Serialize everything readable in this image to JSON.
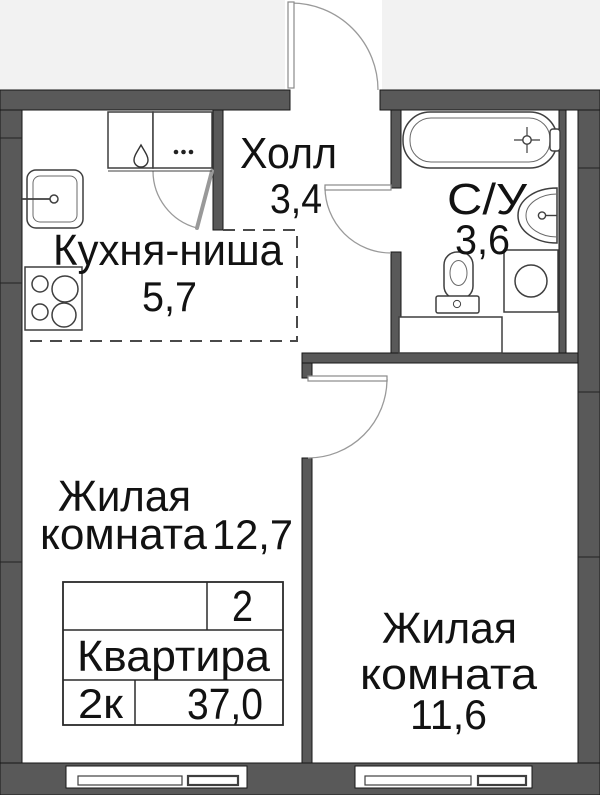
{
  "rooms": {
    "hall": {
      "name": "Холл",
      "area": "3,4"
    },
    "bathroom": {
      "name": "С/У",
      "area": "3,6"
    },
    "kitchen": {
      "name": "Кухня-ниша",
      "area": "5,7"
    },
    "living_left": {
      "name_line1": "Жилая",
      "name_line2": "комната",
      "area": "12,7"
    },
    "living_right": {
      "name_line1": "Жилая",
      "name_line2": "комната",
      "area": "11,6"
    }
  },
  "info_table": {
    "top_value": "2",
    "label": "Квартира",
    "rooms_short": "2к",
    "total_area": "37,0"
  },
  "fixtures": [
    "bathtub",
    "washbasin",
    "toilet",
    "washing-machine",
    "bathroom-cabinet",
    "kitchen-sink",
    "cooktop",
    "kitchen-counter-gas",
    "kitchen-counter-knobs",
    "entrance-door",
    "room-door",
    "bathroom-door",
    "closet-door",
    "window",
    "window"
  ],
  "colors": {
    "wall": "#595959",
    "outline": "#161616",
    "fixture_outline": "#3f3f3f",
    "door": "#9a9a9a",
    "outside_bg": "#f2f2f2",
    "text": "#121212"
  }
}
